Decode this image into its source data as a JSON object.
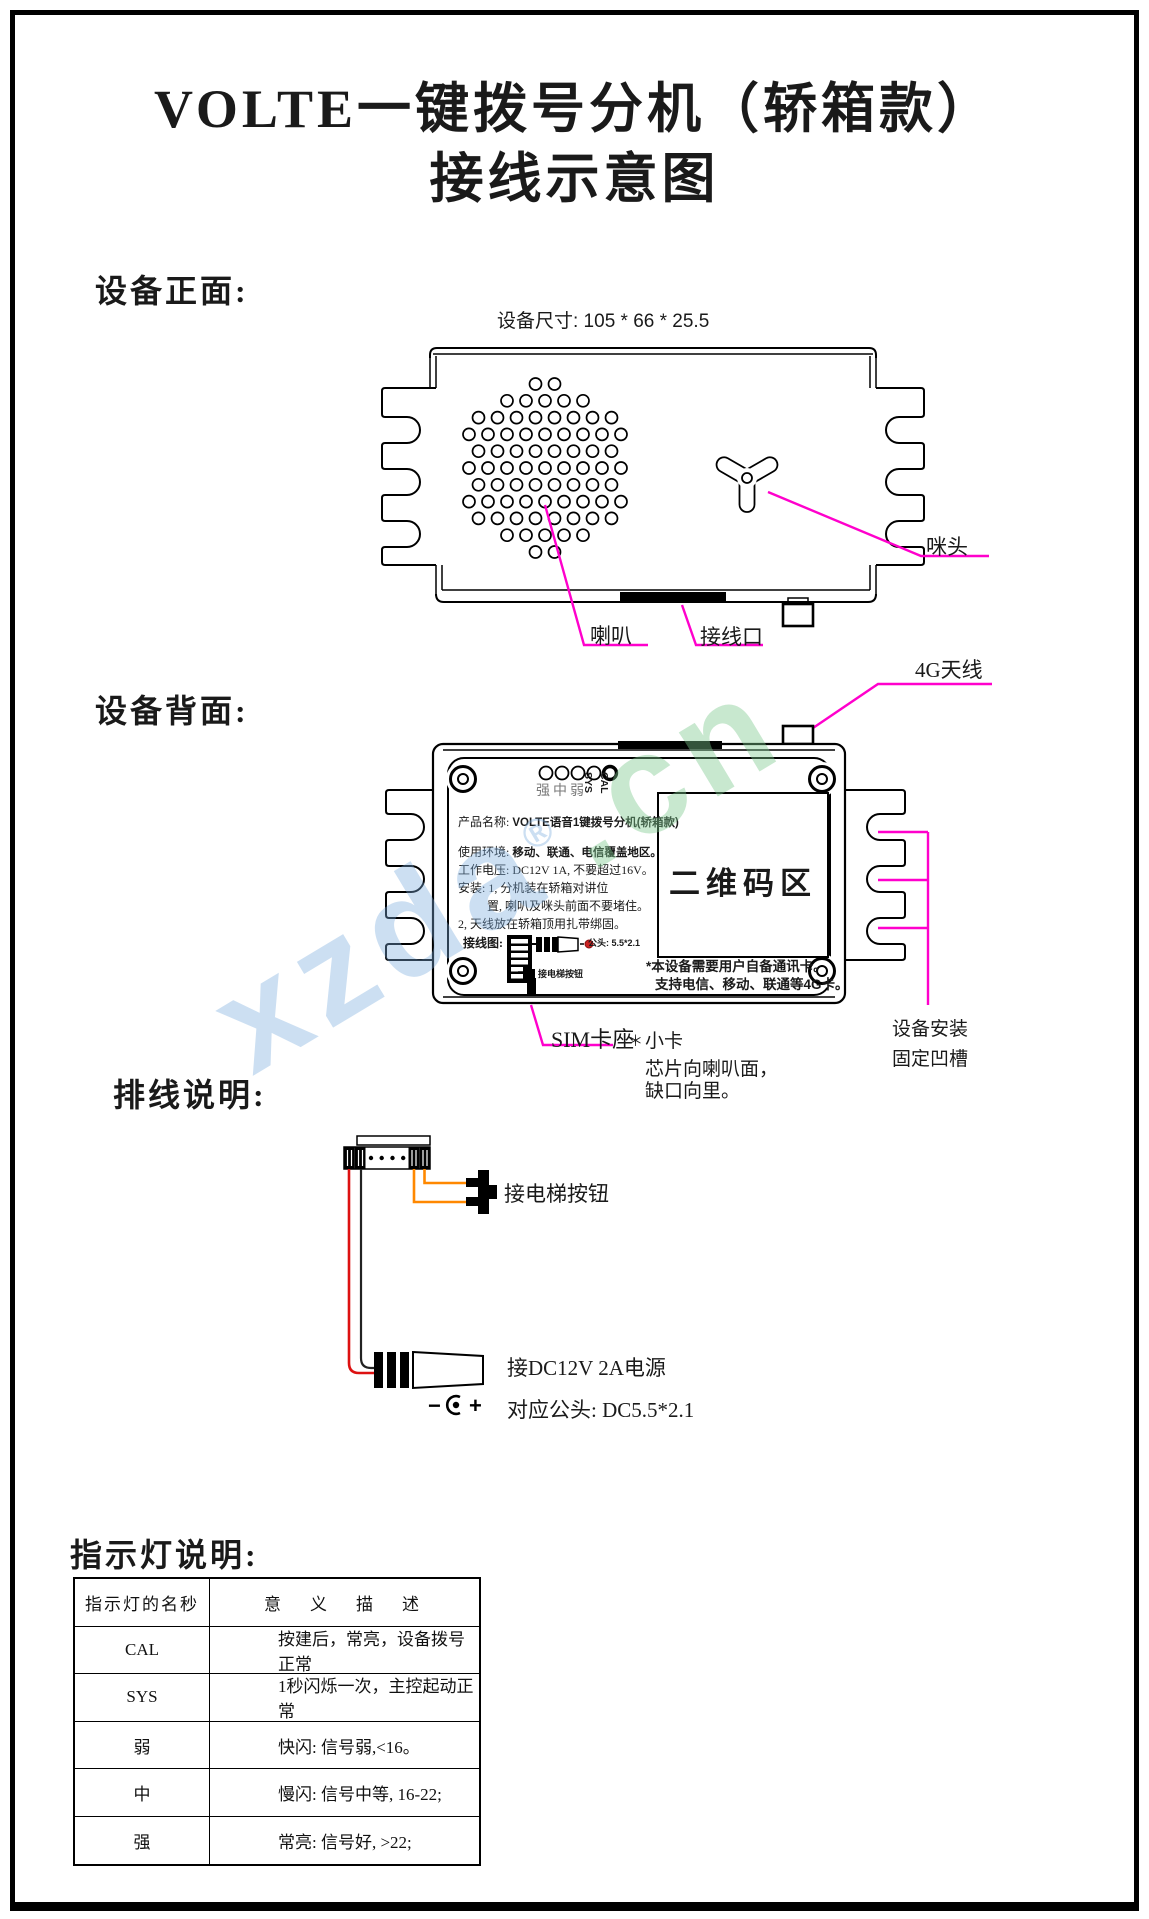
{
  "page": {
    "title_line1": "VOLTE一键拨号分机（轿箱款）",
    "title_line2": "接线示意图"
  },
  "front_section": {
    "heading": "设备正面:",
    "dimensions": "设备尺寸: 105 * 66 * 25.5",
    "labels": {
      "speaker": "喇叭",
      "wiring_port": "接线口",
      "mic": "咪头"
    }
  },
  "back_section": {
    "heading": "设备背面:",
    "antenna_label": "4G天线",
    "led_labels": {
      "signal": "强中弱",
      "sys": "SYS",
      "cal": "CAL"
    },
    "nameplate": {
      "product_name_label": "产品名称:",
      "product_name": "VOLTE语音1键拨号分机(轿箱款)",
      "env_label": "使用环境:",
      "env": "移动、联通、电信覆盖地区。",
      "voltage": "工作电压: DC12V 1A, 不要超过16V。",
      "install_1": "安装: 1, 分机装在轿箱对讲位",
      "install_1b": "置, 喇叭及咪头前面不要堵住。",
      "install_2": "2, 天线放在轿箱顶用扎带绑固。",
      "wiring_label": "接线图:",
      "plug_note": "公头: 5.5*2.1",
      "button_note": "接电梯按钮",
      "qr_area": "二维码区",
      "card_note_1": "*本设备需要用户自备通讯卡。",
      "card_note_2": "支持电信、移动、联通等4G卡。"
    },
    "sim_label": "SIM卡座",
    "sim_star": "＊",
    "sim_desc_1": "小卡",
    "sim_desc_2": "芯片向喇叭面，",
    "sim_desc_3": "缺口向里。",
    "groove_label_1": "设备安装",
    "groove_label_2": "固定凹槽"
  },
  "wiring_section": {
    "heading": "排线说明:",
    "button_label": "接电梯按钮",
    "power_label": "接DC12V 2A电源",
    "plug_label": "对应公头: DC5.5*2.1",
    "polarity_minus": "−",
    "polarity_plus": "+"
  },
  "indicator_section": {
    "heading": "指示灯说明:",
    "table": {
      "col1_header": "指示灯的名秒",
      "col2_header": "意　义　描　述",
      "rows": [
        {
          "name": "CAL",
          "desc": "按建后，常亮，设备拨号正常"
        },
        {
          "name": "SYS",
          "desc": "1秒闪烁一次，主控起动正常"
        },
        {
          "name": "弱",
          "desc": "快闪: 信号弱,<16。"
        },
        {
          "name": "中",
          "desc": "慢闪: 信号中等, 16-22;"
        },
        {
          "name": "强",
          "desc": "常亮: 信号好, >22;"
        }
      ]
    }
  },
  "watermark": {
    "part1": "xzda",
    "part2": ".cn",
    "reg": "®"
  },
  "colors": {
    "callout_magenta": "#ff00cc",
    "wire_red": "#dd1111",
    "wire_orange": "#ff8800",
    "wire_black": "#222222",
    "led_dot_red": "#cc2222",
    "watermark_blue": "#78aadc",
    "watermark_green": "#7dc88c"
  }
}
